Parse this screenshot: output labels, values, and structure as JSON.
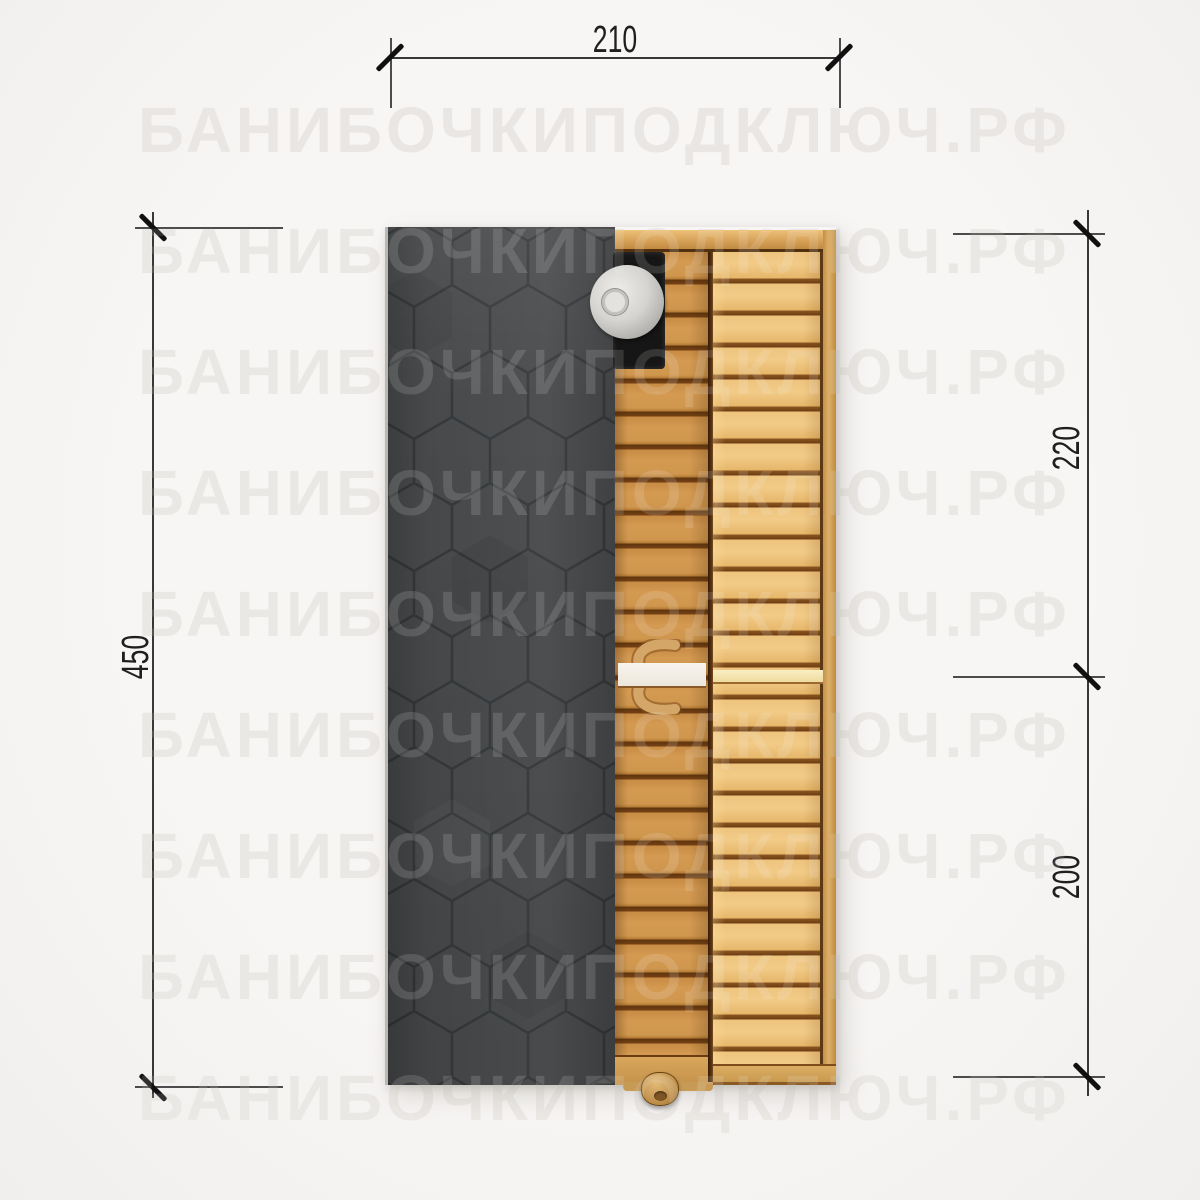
{
  "watermark": {
    "text": "БАНИБОЧКИПОДКЛЮЧ.РФ",
    "color": "#e9e6e3",
    "row_count": 9
  },
  "dimensions": {
    "top_width": {
      "value": "210",
      "orientation": "horizontal"
    },
    "left_height": {
      "value": "450",
      "orientation": "vertical"
    },
    "right_upper": {
      "value": "220",
      "orientation": "vertical"
    },
    "right_lower": {
      "value": "200",
      "orientation": "vertical"
    }
  },
  "plan": {
    "colors": {
      "background": "#f6f4f3",
      "roof_shingles": "#47494b",
      "roof_hex_lines": "#343739",
      "wood_door_section": "#c98f4a",
      "wood_deck_section": "#eec47e",
      "wood_gap": "#6e3e12",
      "wood_frame": "#ddb069",
      "bench_white": "#f5f2ea",
      "bench_cream": "#f6e5ad",
      "chimney_body": "#161616",
      "chimney_cap": "#c9c6c2",
      "dimension_line": "#383838",
      "dimension_text": "#1f1f1f"
    }
  }
}
